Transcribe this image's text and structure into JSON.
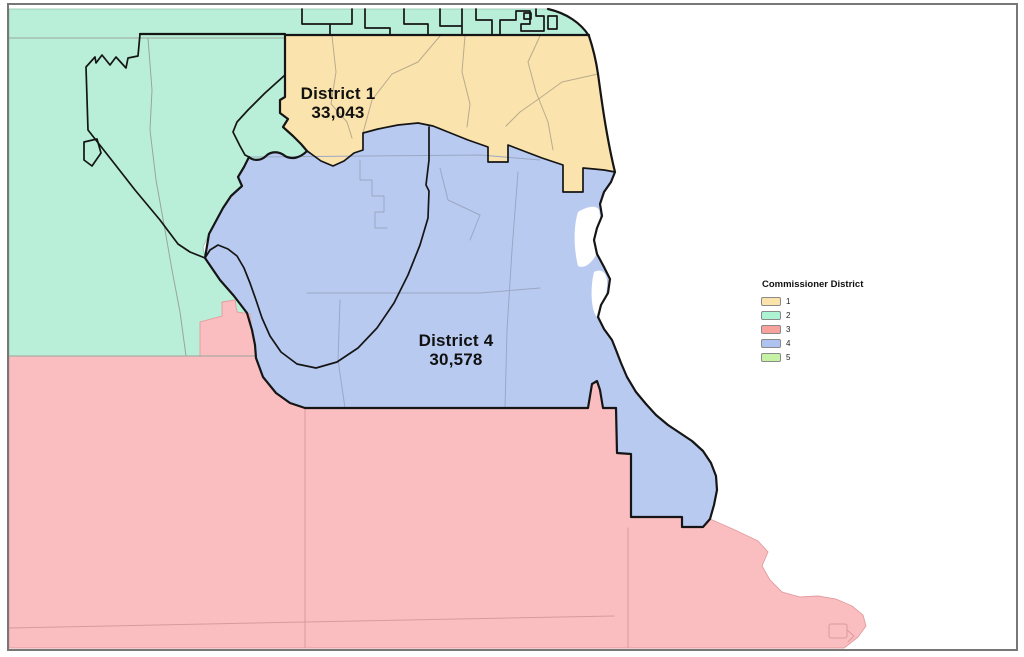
{
  "map": {
    "title_hint": "County commissioner district map",
    "labels": {
      "district1": {
        "name": "District 1",
        "population": "33,043"
      },
      "district4": {
        "name": "District 4",
        "population": "30,578"
      }
    },
    "colors": {
      "district1_fill": "#FAE3AC",
      "district2_fill": "#B9EFD8",
      "district3_fill": "#FBBEC0",
      "district4_fill": "#B9CAF1",
      "boundary": "#151515",
      "precinct_line": "#9aa49c",
      "precinct_line_warm": "#b9ab8e",
      "precinct_line_cool": "#9aa7c4",
      "precinct_line_pink": "#d89a9c",
      "frame": "#777777",
      "background": "#ffffff",
      "label_text": "#111111"
    }
  },
  "legend": {
    "title": "Commissioner District",
    "items": [
      {
        "label": "1",
        "color": "#FBE3AB"
      },
      {
        "label": "2",
        "color": "#AEF2D4"
      },
      {
        "label": "3",
        "color": "#F8A29E"
      },
      {
        "label": "4",
        "color": "#AEC3F0"
      },
      {
        "label": "5",
        "color": "#C5F2A4"
      }
    ]
  }
}
